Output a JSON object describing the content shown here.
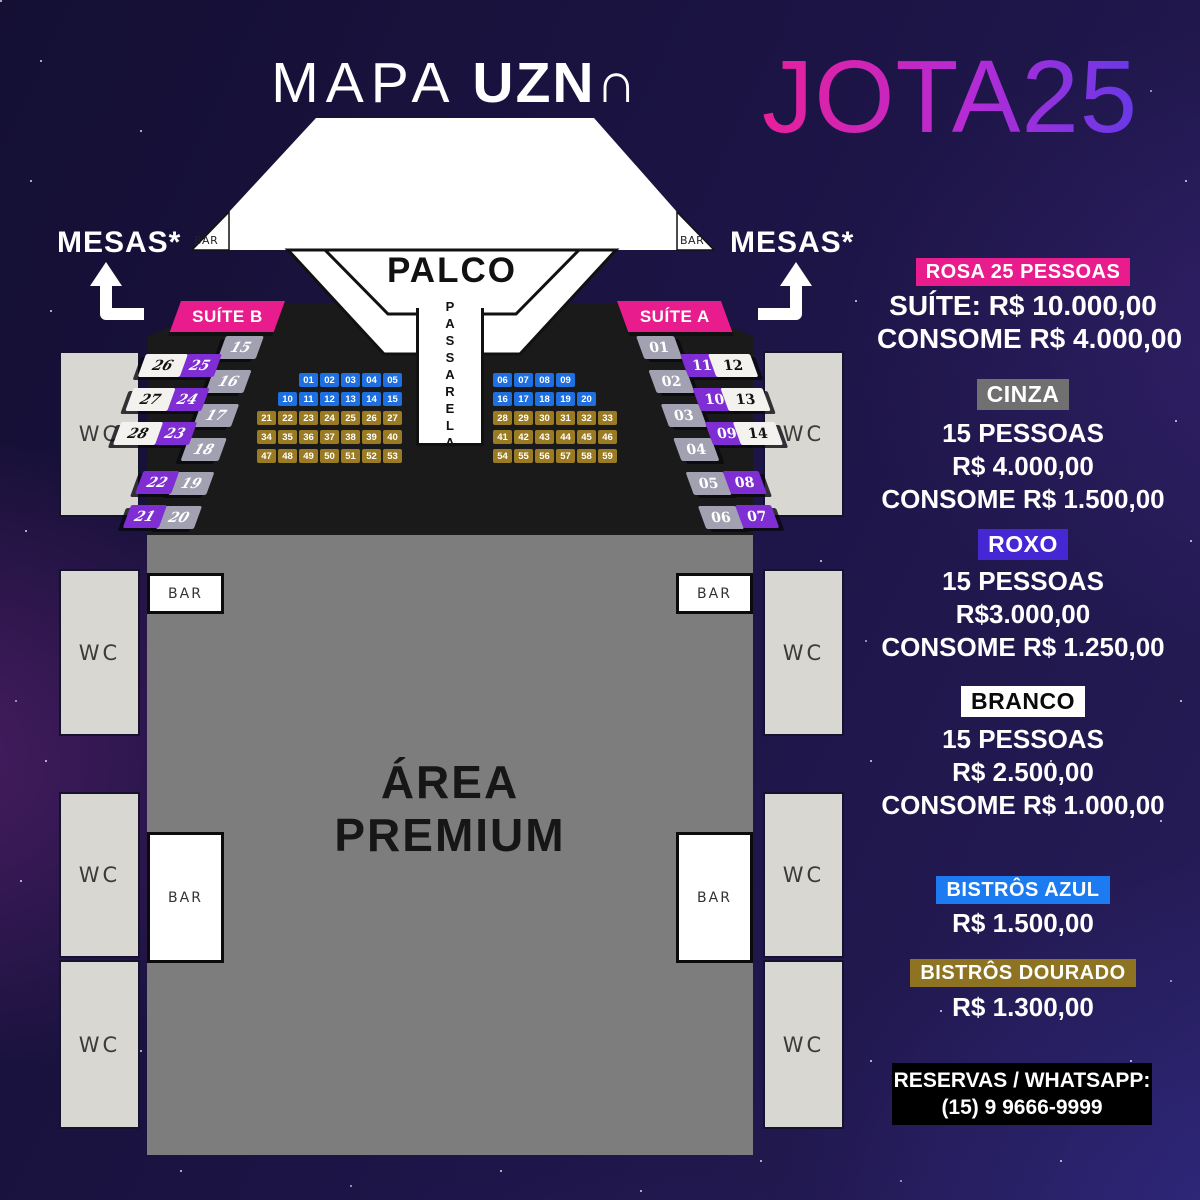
{
  "header": {
    "map_title_light": "MAPA",
    "map_title_bold": "UZN∩",
    "event_logo": "JOTA25"
  },
  "mesas": {
    "left_label": "MESAS*",
    "right_label": "MESAS*"
  },
  "stage": {
    "palco_label": "PALCO",
    "passarela_label": "PASSARELA"
  },
  "facilities": {
    "wc_label": "WC",
    "bar_label": "BAR"
  },
  "premium": {
    "line1": "ÁREA",
    "line2": "PREMIUM"
  },
  "suites": {
    "left": {
      "banner": "SUÍTE B",
      "gray": [
        "15",
        "16",
        "17",
        "18",
        "19",
        "20"
      ],
      "purple": [
        "25",
        "24",
        "23",
        "22",
        "21"
      ],
      "white": [
        "26",
        "27",
        "28"
      ]
    },
    "right": {
      "banner": "SUÍTE A",
      "gray": [
        "01",
        "02",
        "03",
        "04",
        "05",
        "06"
      ],
      "purple": [
        "11",
        "10",
        "09",
        "08",
        "07"
      ],
      "white": [
        "12",
        "13",
        "14"
      ]
    }
  },
  "bistros": {
    "left_rows": [
      {
        "color": "blue",
        "cells": [
          "01",
          "02",
          "03",
          "04",
          "05"
        ]
      },
      {
        "color": "blue",
        "cells": [
          "10",
          "11",
          "12",
          "13",
          "14",
          "15"
        ]
      },
      {
        "color": "gold",
        "cells": [
          "21",
          "22",
          "23",
          "24",
          "25",
          "26",
          "27"
        ]
      },
      {
        "color": "gold",
        "cells": [
          "34",
          "35",
          "36",
          "37",
          "38",
          "39",
          "40"
        ]
      },
      {
        "color": "gold",
        "cells": [
          "47",
          "48",
          "49",
          "50",
          "51",
          "52",
          "53"
        ]
      }
    ],
    "right_rows": [
      {
        "color": "blue",
        "cells": [
          "06",
          "07",
          "08",
          "09"
        ]
      },
      {
        "color": "blue",
        "cells": [
          "16",
          "17",
          "18",
          "19",
          "20"
        ]
      },
      {
        "color": "gold",
        "cells": [
          "28",
          "29",
          "30",
          "31",
          "32",
          "33"
        ]
      },
      {
        "color": "gold",
        "cells": [
          "41",
          "42",
          "43",
          "44",
          "45",
          "46"
        ]
      },
      {
        "color": "gold",
        "cells": [
          "54",
          "55",
          "56",
          "57",
          "58",
          "59"
        ]
      }
    ]
  },
  "legend": {
    "rosa": {
      "badge": "ROSA 25 PESSOAS",
      "line1": "SUÍTE: R$ 10.000,00",
      "line2": "CONSOME R$ 4.000,00"
    },
    "cinza": {
      "badge": "CINZA",
      "line1": "15 PESSOAS",
      "line2": "R$ 4.000,00",
      "line3": "CONSOME R$ 1.500,00"
    },
    "roxo": {
      "badge": "ROXO",
      "line1": "15 PESSOAS",
      "line2": "R$3.000,00",
      "line3": "CONSOME R$ 1.250,00"
    },
    "branco": {
      "badge": "BRANCO",
      "line1": "15 PESSOAS",
      "line2": "R$ 2.500,00",
      "line3": "CONSOME R$ 1.000,00"
    },
    "azul": {
      "badge": "BISTRÔS AZUL",
      "line1": "R$ 1.500,00"
    },
    "dourado": {
      "badge": "BISTRÔS DOURADO",
      "line1": "R$ 1.300,00"
    }
  },
  "reservas": {
    "line1": "RESERVAS / WHATSAPP:",
    "line2": "(15) 9 9666-9999"
  },
  "colors": {
    "background": "#1d1547",
    "pink": "#e91c8e",
    "bistro_blue": "#1e6fe0",
    "bistro_gold": "#9a7b23",
    "seat_purple": "#7e2ed2",
    "seat_gray": "#a2a1b2",
    "seat_white": "#f4f2ee",
    "badge_roxo": "#4527d4",
    "badge_cinza": "#707070",
    "badge_azul": "#1d7bf2",
    "badge_dourado": "#8e7422",
    "premium_gray": "#7d7d7d",
    "dark_platform": "#1a1a1a",
    "logo_gradient_start": "#ef1e91",
    "logo_gradient_end": "#5b3bea"
  }
}
